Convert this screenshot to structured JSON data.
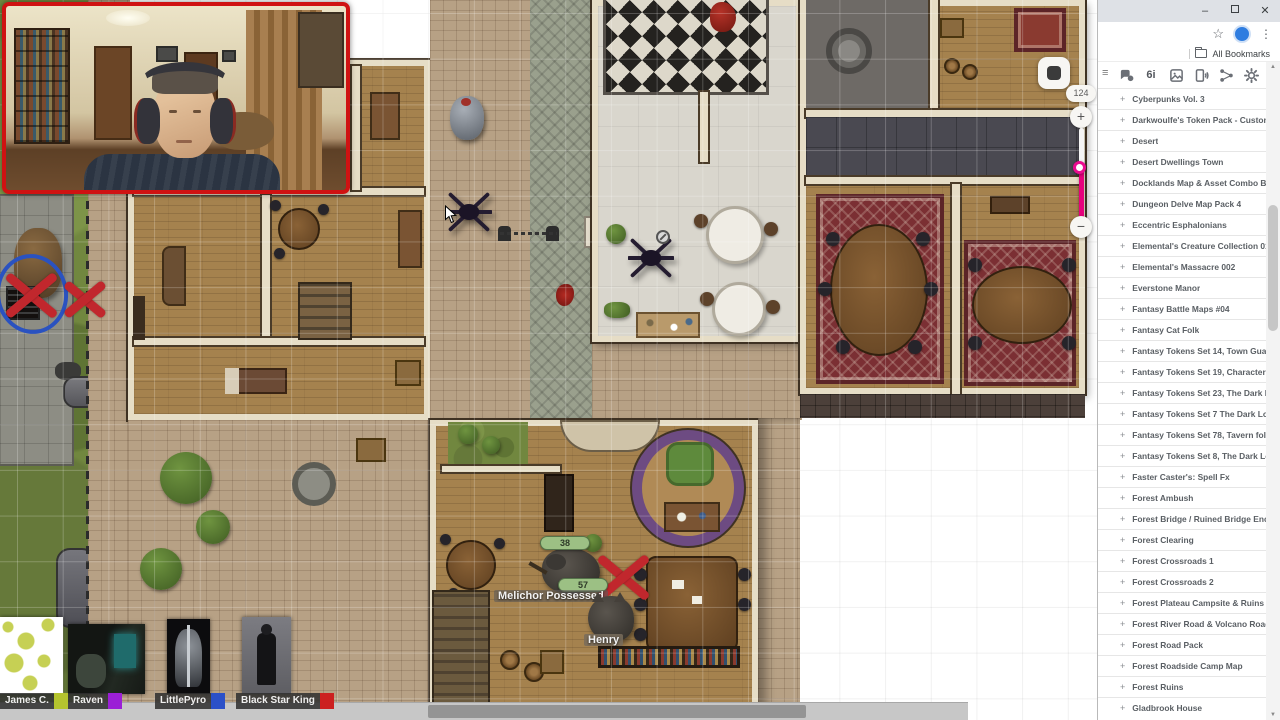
{
  "browser": {
    "titlebar": {
      "minimize_icon": "–",
      "maximize_icon": "maximize-square",
      "close_icon": "✕"
    },
    "toolbar": {
      "bookmark_star_icon": "☆",
      "profile_avatar": "blue-circle",
      "menu_icon": "⋮"
    },
    "bookmarks_bar": {
      "folder_icon": "folder",
      "label": "All Bookmarks"
    }
  },
  "library": {
    "hamburger_icon": "≡",
    "toolbar_icons": [
      "chat-icon",
      "dice-6i-icon",
      "image-icon",
      "audio-icon",
      "share-icon",
      "settings-icon"
    ],
    "dice_icon_label": "6i",
    "expander_icon": "+",
    "scroll_up_icon": "▲",
    "scroll_down_icon": "▼",
    "items": [
      "Cyberpunks Vol. 3",
      "Darkwoulfe's Token Pack - Customizab...",
      "Desert",
      "Desert Dwellings Town",
      "Docklands Map & Asset Combo Bundle",
      "Dungeon Delve Map Pack 4",
      "Eccentric Esphalonians",
      "Elemental's Creature Collection 015",
      "Elemental's Massacre 002",
      "Everstone Manor",
      "Fantasy Battle Maps #04",
      "Fantasy Cat Folk",
      "Fantasy Tokens Set 14, Town Guards",
      "Fantasy Tokens Set 19, Character Folio 2",
      "Fantasy Tokens Set 23, The Dark Lord'...",
      "Fantasy Tokens Set 7 The Dark Lord's ...",
      "Fantasy Tokens Set 78, Tavern folk",
      "Fantasy Tokens Set 8, The Dark Lord's ...",
      "Faster Caster's: Spell Fx",
      "Forest Ambush",
      "Forest Bridge / Ruined Bridge Encount...",
      "Forest Clearing",
      "Forest Crossroads 1",
      "Forest Crossroads 2",
      "Forest Plateau Campsite & Ruins",
      "Forest River Road & Volcano Road Map",
      "Forest Road Pack",
      "Forest Roadside Camp Map",
      "Forest Ruins",
      "Gladbrook House"
    ]
  },
  "canvas": {
    "zoom_level": "124",
    "zoom_in_icon": "+",
    "zoom_out_icon": "−",
    "slider_accent_color": "#e6007d",
    "map_tool_button": "dark-rounded-square",
    "tokens": {
      "melichor_label": "Melichor Possessed",
      "melichor_hp": "38",
      "crossed_hp": "57",
      "henry_label": "Henry"
    },
    "marker_color_red_x": "#c1272d",
    "marker_color_blue_ring": "#2a52c0"
  },
  "webcam": {
    "border_color": "#cf1212"
  },
  "players": [
    {
      "name": "James C.",
      "color": "#b5c42e"
    },
    {
      "name": "Raven",
      "color": "#9b1fd6"
    },
    {
      "name": "LittlePyro",
      "color": "#2b50c8"
    },
    {
      "name": "Black Star King",
      "color": "#cc2020"
    }
  ]
}
